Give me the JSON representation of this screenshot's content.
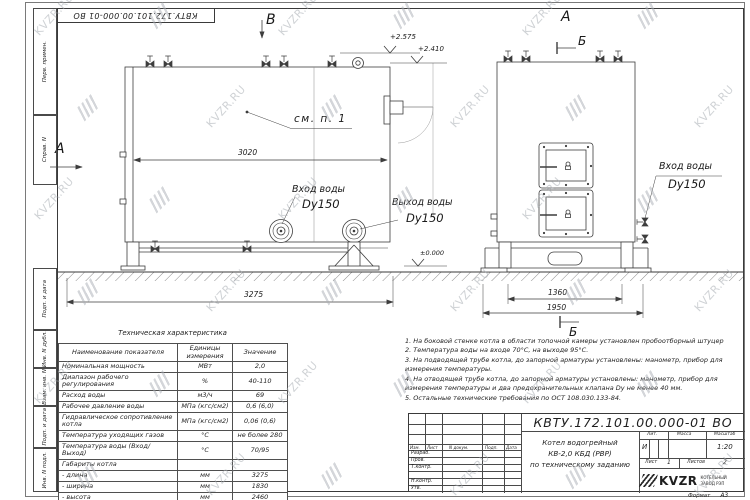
{
  "stamp": {
    "doc_number": "КВТУ.172.101.00.000-01 ВО"
  },
  "frame_labels": {
    "items": [
      "Перв. примен.",
      "Справ. N",
      "Подп. и дата",
      "Инв. N дубл.",
      "Взам. инв. N",
      "Подп. и дата",
      "Инв. N подл."
    ]
  },
  "front_view": {
    "view_letter": "В",
    "side_letter": "А",
    "callout": "см. п. 1",
    "dim_inner_width": "3020",
    "dim_outer_width": "3275",
    "elevation_top": "+2.575",
    "elevation_mid": "+2.410",
    "elevation_zero": "±0.000",
    "inlet_line1": "Вход воды",
    "inlet_line2": "Dy150",
    "outlet_line1": "Выход воды",
    "outlet_line2": "Dy150"
  },
  "side_view": {
    "view_letter": "А",
    "section_letter_top": "Б",
    "section_letter_bottom": "Б",
    "inlet_line1": "Вход воды",
    "inlet_line2": "Dy150",
    "dim_inner": "1360",
    "dim_outer": "1950"
  },
  "spec_table": {
    "title": "Техническая характеристика",
    "headers": [
      "Наименование показателя",
      "Единицы измерения",
      "Значение"
    ],
    "rows": [
      [
        "Номинальная мощность",
        "МВт",
        "2,0"
      ],
      [
        "Диапазон рабочего регулирования",
        "%",
        "40-110"
      ],
      [
        "Расход воды",
        "м3/ч",
        "69"
      ],
      [
        "Рабочее давление воды",
        "МПа (кгс/см2)",
        "0,6 (6,0)"
      ],
      [
        "Гидравлическое сопротивление котла",
        "МПа (кгс/см2)",
        "0,06 (0,6)"
      ],
      [
        "Температура уходящих газов",
        "°С",
        "не более 280"
      ],
      [
        "Температура воды (Вход/Выход)",
        "°С",
        "70/95"
      ],
      [
        "Габариты котла",
        "",
        ""
      ],
      [
        "- длина",
        "мм",
        "3275"
      ],
      [
        "- ширина",
        "мм",
        "1830"
      ],
      [
        "- высота",
        "мм",
        "2460"
      ]
    ]
  },
  "notes": {
    "items": [
      "1. На боковой стенке котла в области топочной камеры установлен пробоотборный штуцер",
      "2. Температура воды на входе 70°С, на выходе 95°С.",
      "3. На подводящей трубе котла, до запорной арматуры установлены: манометр, прибор для измерения температуры.",
      "4. На отводящей трубе котла, до запорной арматуры установлены: манометр, прибор для измерения температуры и два предохранительных клапана Dy не менее 40 мм.",
      "5. Остальные технические требования по ОСТ 108.030.133-84."
    ]
  },
  "title_block": {
    "doc_number": "КВТУ.172.101.00.000-01 ВО",
    "header_cols": [
      "Изм.",
      "Лист",
      "N докум.",
      "Подп.",
      "Дата"
    ],
    "sign_rows": [
      "Разраб.",
      "Пров.",
      "Т.контр.",
      "",
      "Н.контр.",
      "Утв."
    ],
    "title_lines": [
      "Котел водогрейный",
      "КВ-2,0 КБД (РВР)",
      "по техническому заданию"
    ],
    "lit_label": "Лит.",
    "lit_value": "И",
    "mass_label": "Масса",
    "scale_label": "Масштаб",
    "scale_value": "1:20",
    "sheet_label": "Лист",
    "sheet_value": "1",
    "sheets_label": "Листов",
    "sheets_value": "2",
    "logo_text": "KVZR",
    "company_line1": "КОТЕЛЬНЫЙ",
    "company_line2": "ЗАВОД РЭП",
    "format_label": "Формат",
    "format_value": "А3"
  },
  "watermark": {
    "text": "KVZR.RU"
  }
}
